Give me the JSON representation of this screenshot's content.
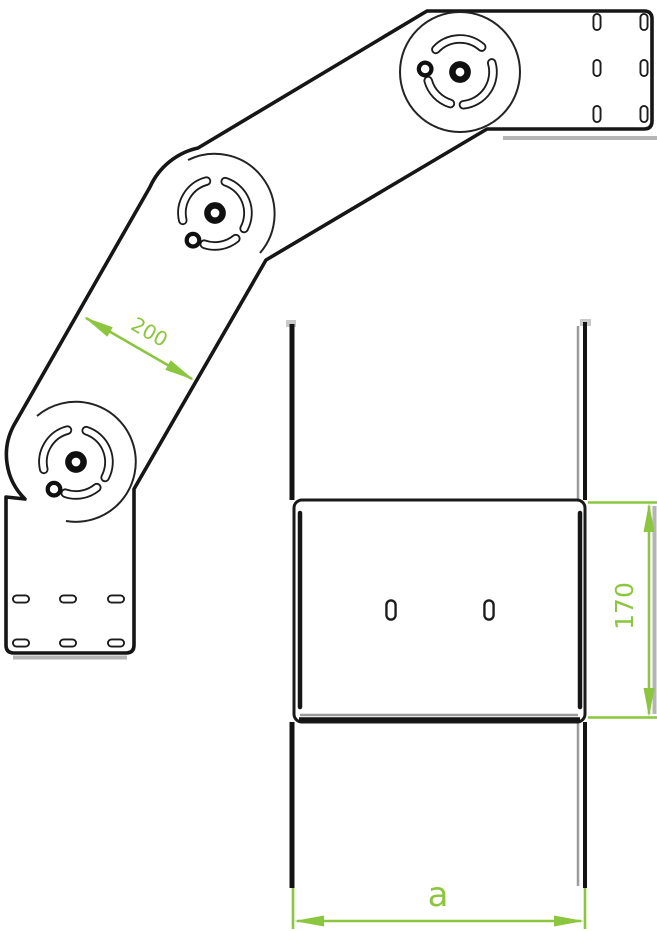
{
  "drawing": {
    "kind": "technical-drawing",
    "dimensions": {
      "segment_length": "200",
      "tray_width": "170",
      "length_variable": "a"
    },
    "colors": {
      "dimension_green": "#8cc63f",
      "line_black": "#161616",
      "shadow_gray": "#b5b5b5"
    }
  }
}
